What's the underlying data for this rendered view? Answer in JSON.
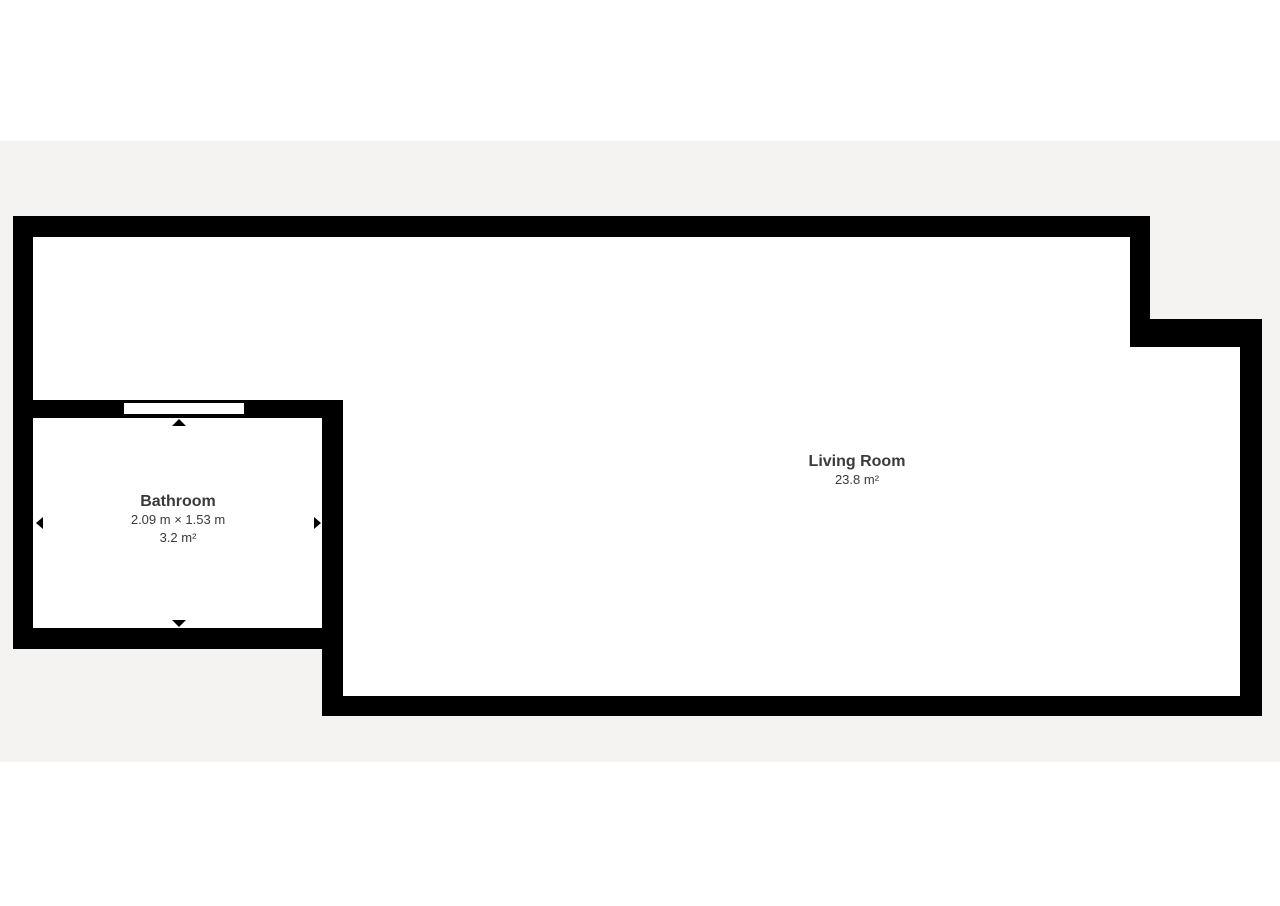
{
  "palette": {
    "page_background": "#ffffff",
    "canvas_background": "#f4f3f1",
    "wall_color": "#000000",
    "floor_color": "#ffffff",
    "label_text_color": "#3a3a3a"
  },
  "rooms": {
    "living_room": {
      "name": "Living Room",
      "area": "23.8 m²"
    },
    "bathroom": {
      "name": "Bathroom",
      "dimensions": "2.09 m × 1.53 m",
      "area": "3.2 m²"
    }
  }
}
